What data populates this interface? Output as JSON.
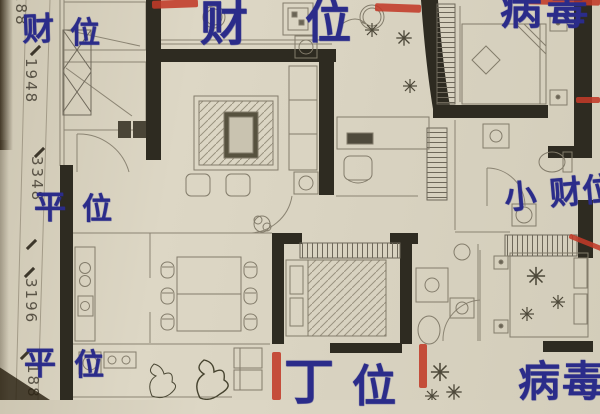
{
  "photo": {
    "paper_color": "#d8d2c0",
    "wall_color": "#2e2b21",
    "pencil_color": "#8b8473",
    "ink_color": "#2b2c8a",
    "red_color": "#c23a28"
  },
  "labels": {
    "top_left": {
      "c1": "财",
      "c2": "位"
    },
    "top_center": {
      "c1": "财",
      "c2": "位"
    },
    "top_right": "病毒",
    "mid_left": {
      "c1": "平",
      "c2": "位"
    },
    "mid_right": "小 财位",
    "bottom_left": {
      "c1": "平",
      "c2": "位"
    },
    "bottom_center": {
      "c1": "丁",
      "c2": "位"
    },
    "bottom_right": "病毒"
  },
  "dimensions": [
    "188",
    "1948",
    "3348",
    "3196",
    "188"
  ]
}
